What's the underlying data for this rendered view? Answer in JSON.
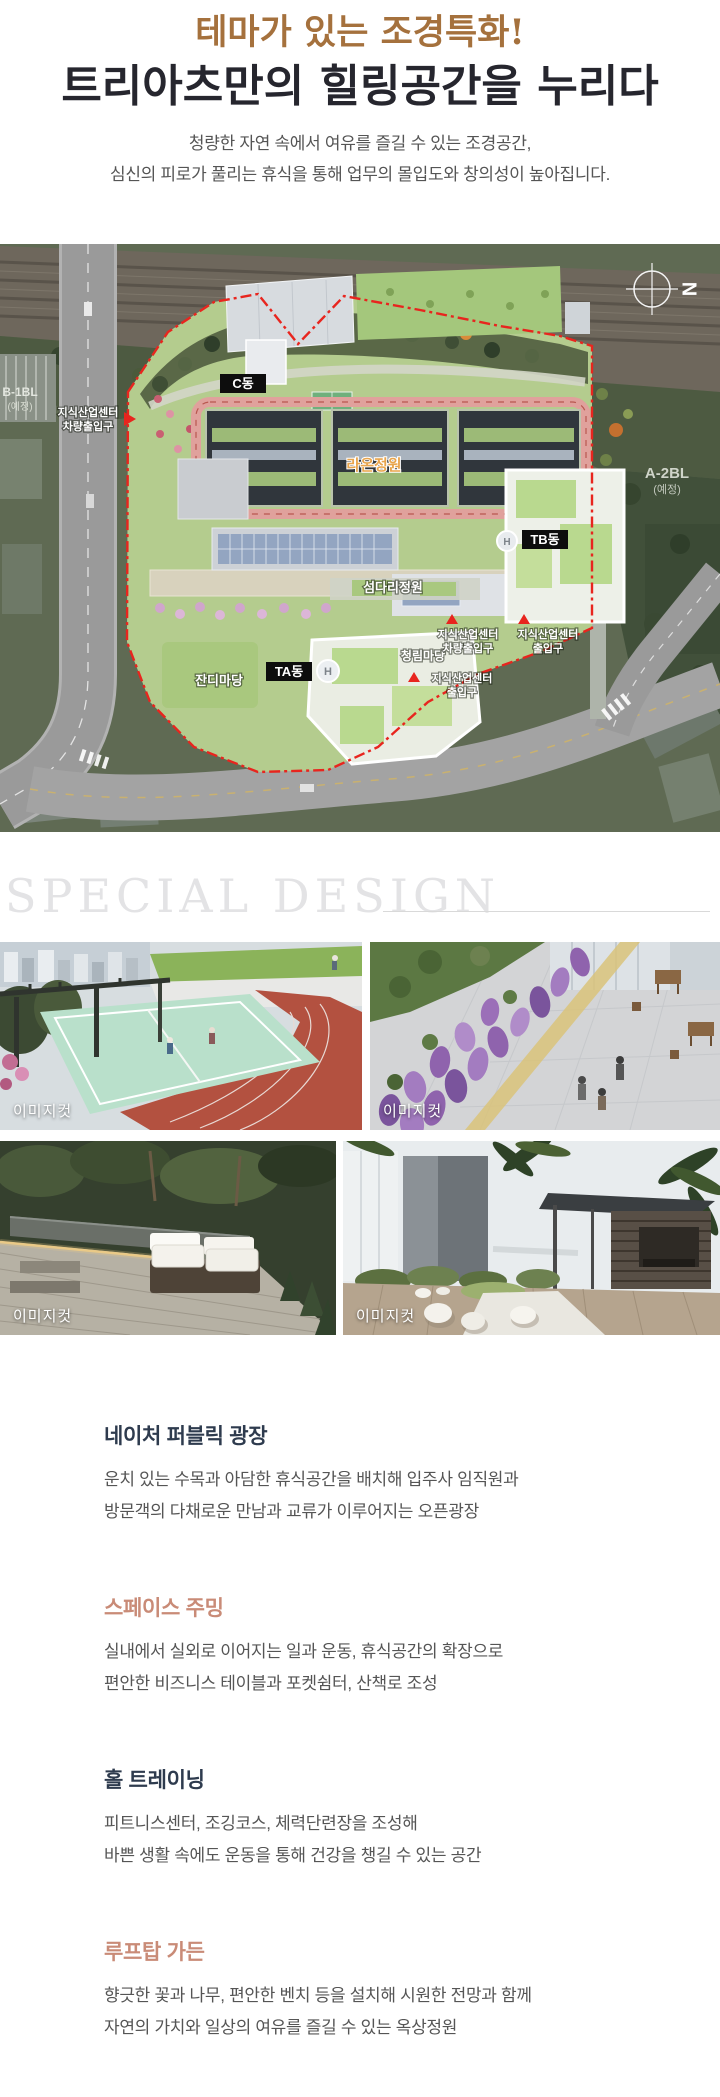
{
  "header": {
    "title_accent": "테마가 있는 조경특화!",
    "title_main": "트리아츠만의 힐링공간을 누리다",
    "subtitle_line1": "청량한 자연 속에서 여유를 즐길 수 있는 조경공간,",
    "subtitle_line2": "심신의 피로가 풀리는 휴식을 통해 업무의 몰입도와 창의성이 높아집니다.",
    "accent_color": "#a5713d",
    "title_color": "#26262e"
  },
  "site_plan": {
    "compass": "N",
    "helipad": "H",
    "boundary_color": "#e8251e",
    "buildings": {
      "c": "C동",
      "ta": "TA동",
      "tb": "TB동"
    },
    "gardens": {
      "raon": "라온정원",
      "seomdari": "섬다리정원",
      "jandi": "잔디마당",
      "cheongnim": "청림마당"
    },
    "areas": {
      "a2bl": "A-2BL",
      "a2bl_note": "(예정)",
      "b1bl": "B-1BL",
      "b1bl_note": "(예정)"
    },
    "entrances": {
      "left_line1": "지식산업센터",
      "left_line2": "차량출입구",
      "b1_line1": "지식산업센터",
      "b1_line2": "차량출입구",
      "b2_line1": "지식산업센터",
      "b2_line2": "출입구",
      "b3_line1": "지식산업센터",
      "b3_line2": "출입구"
    }
  },
  "special_design": {
    "heading": "SPECIAL DESIGN"
  },
  "gallery": {
    "caption": "이미지컷",
    "photos": [
      {
        "name": "rooftop-sports-court"
      },
      {
        "name": "lavender-plaza"
      },
      {
        "name": "wood-deck-lounge"
      },
      {
        "name": "garden-cabana"
      }
    ]
  },
  "sections": [
    {
      "heading": "네이처 퍼블릭 광장",
      "color": "#2e3b4e",
      "line1": "운치 있는 수목과 아담한 휴식공간을 배치해 입주사 임직원과",
      "line2": "방문객의 다채로운 만남과 교류가 이루어지는 오픈광장"
    },
    {
      "heading": "스페이스 주밍",
      "color": "#c98b77",
      "line1": "실내에서 실외로 이어지는 일과 운동, 휴식공간의 확장으로",
      "line2": "편안한 비즈니스 테이블과 포켓쉼터, 산책로 조성"
    },
    {
      "heading": "홀 트레이닝",
      "color": "#2e3b4e",
      "line1": "피트니스센터, 조깅코스, 체력단련장을 조성해",
      "line2": "바쁜 생활 속에도 운동을 통해 건강을 챙길 수 있는 공간"
    },
    {
      "heading": "루프탑 가든",
      "color": "#c98b77",
      "line1": "향긋한 꽃과 나무, 편안한 벤치 등을 설치해 시원한 전망과 함께",
      "line2": "자연의 가치와 일상의 여유를 즐길 수 있는 옥상정원"
    }
  ]
}
